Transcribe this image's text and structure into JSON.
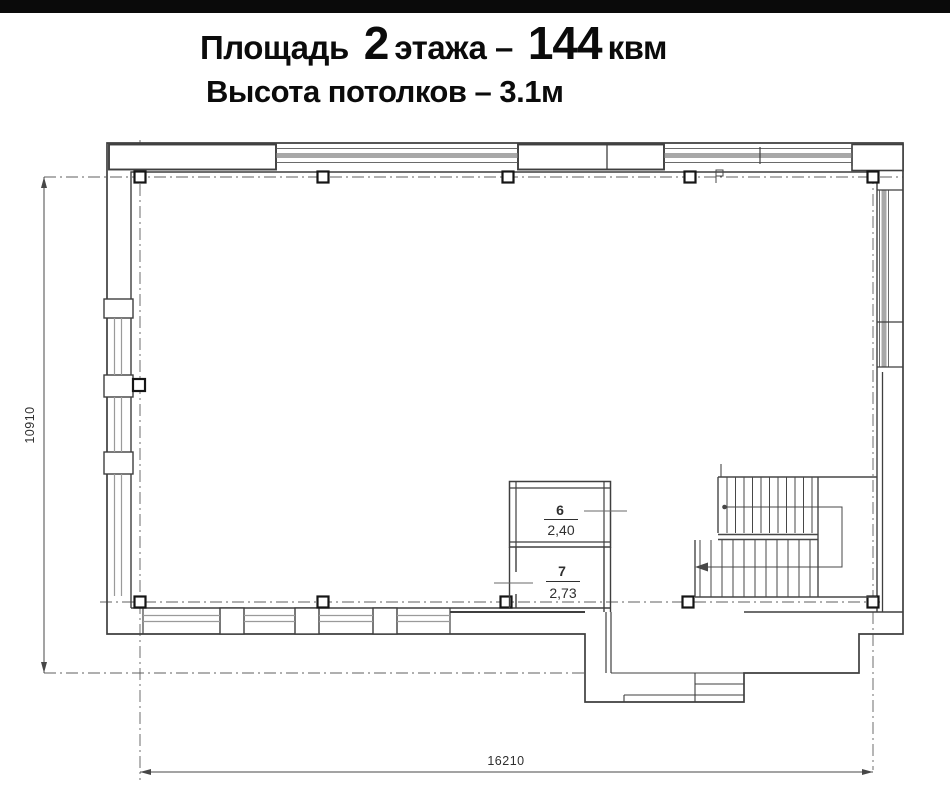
{
  "title": {
    "p1": "Площадь",
    "p2": "2",
    "p3": "этажа –",
    "p4": "144",
    "p5": "квм",
    "line2": "Высота потолков – 3.1м"
  },
  "plan": {
    "dim_width": "16210",
    "dim_height": "10910",
    "rooms": [
      {
        "number": "6",
        "area": "2,40"
      },
      {
        "number": "7",
        "area": "2,73"
      }
    ]
  },
  "colors": {
    "wall": "#3f3f3f",
    "thin": "#6a6a6a",
    "win": "#9a9a9a",
    "band": "#a8a8a8",
    "axis": "#5f5f5f",
    "dim": "#474747",
    "ink": "#2f2f2f",
    "title": "#0b0b0b",
    "bar": "#0a0a0a"
  }
}
